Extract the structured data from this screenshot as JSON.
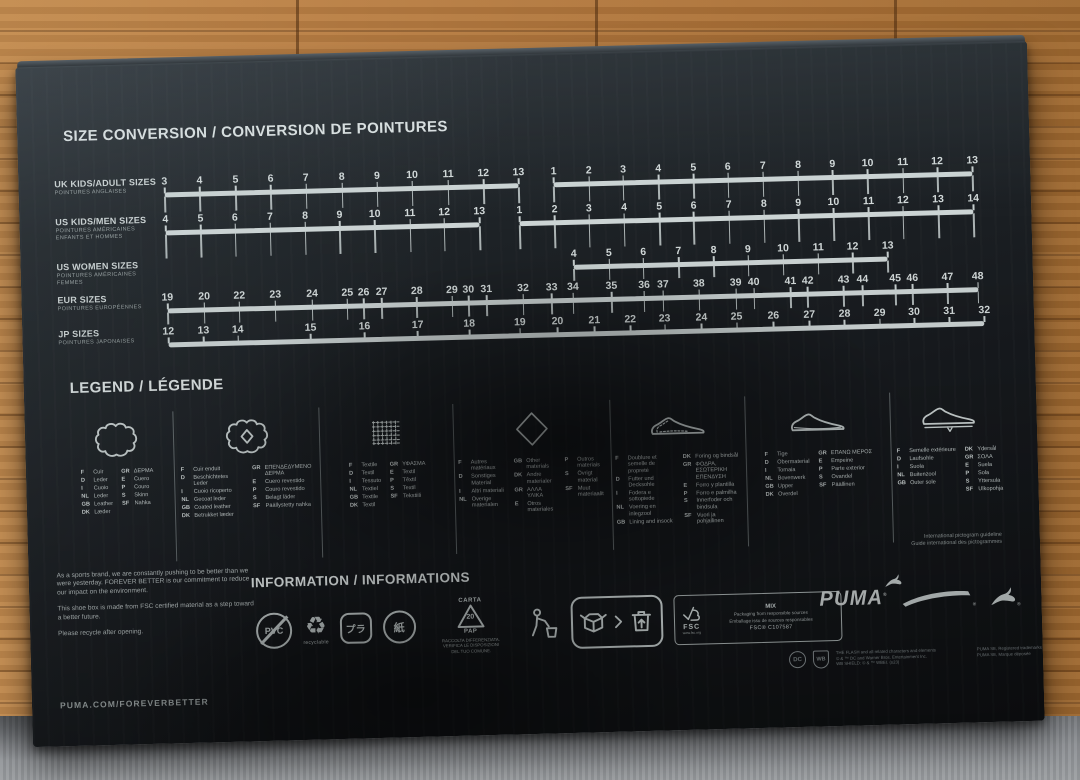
{
  "colors": {
    "print": "#ccd4d4",
    "box": "#1b2024",
    "wood": "#b57b41",
    "carpet": "#8e9195"
  },
  "size_chart": {
    "title": "SIZE CONVERSION / CONVERSION DE POINTURES",
    "rows": [
      {
        "label": "UK KIDS/ADULT SIZES",
        "sublabel": [
          "POINTURES ANGLAISES"
        ],
        "segments": [
          {
            "values": [
              "3",
              "4",
              "5",
              "6",
              "7",
              "8",
              "9",
              "10",
              "11",
              "12",
              "13"
            ],
            "positions": [
              0,
              4.3,
              8.7,
              13,
              17.3,
              21.7,
              26,
              30.3,
              34.7,
              39,
              43.3
            ]
          },
          {
            "values": [
              "1",
              "2",
              "3",
              "4",
              "5",
              "6",
              "7",
              "8",
              "9",
              "10",
              "11",
              "12",
              "13"
            ],
            "positions": [
              47.6,
              51.9,
              56.1,
              60.4,
              64.7,
              68.9,
              73.2,
              77.5,
              81.7,
              86,
              90.3,
              94.5,
              98.8
            ]
          }
        ]
      },
      {
        "label": "US KIDS/MEN SIZES",
        "sublabel": [
          "POINTURES AMÉRICAINES",
          "ENFANTS ET HOMMES"
        ],
        "segments": [
          {
            "values": [
              "4",
              "5",
              "6",
              "7",
              "8",
              "9",
              "10",
              "11",
              "12",
              "13"
            ],
            "positions": [
              0,
              4.3,
              8.5,
              12.8,
              17.1,
              21.3,
              25.6,
              29.9,
              34.1,
              38.4
            ]
          },
          {
            "values": [
              "1",
              "2",
              "3",
              "4",
              "5",
              "6",
              "7",
              "8",
              "9",
              "10",
              "11",
              "12",
              "13",
              "14"
            ],
            "positions": [
              43.3,
              47.6,
              51.8,
              56.1,
              60.4,
              64.6,
              68.9,
              73.2,
              77.4,
              81.7,
              86,
              90.2,
              94.5,
              98.8
            ]
          }
        ]
      },
      {
        "label": "US WOMEN SIZES",
        "sublabel": [
          "POINTURES AMÉRICAINES",
          "FEMMES"
        ],
        "segments": [
          {
            "values": [
              "4",
              "5",
              "6",
              "7",
              "8",
              "9",
              "10",
              "11",
              "12",
              "13"
            ],
            "positions": [
              49.8,
              54.1,
              58.3,
              62.6,
              66.9,
              71.1,
              75.4,
              79.7,
              83.9,
              88.2
            ]
          }
        ]
      },
      {
        "label": "EUR SIZES",
        "sublabel": [
          "POINTURES EUROPÉENNES"
        ],
        "segments": [
          {
            "values": [
              "19",
              "20",
              "22",
              "23",
              "24",
              "25",
              "26",
              "27",
              "28",
              "29",
              "30",
              "31",
              "32",
              "33",
              "34",
              "35",
              "36",
              "37",
              "38",
              "39",
              "40",
              "41",
              "42",
              "43",
              "44",
              "45",
              "46",
              "47",
              "48"
            ],
            "positions": [
              0,
              4.5,
              8.8,
              13.2,
              17.7,
              22,
              24,
              26.2,
              30.5,
              34.8,
              36.8,
              39,
              43.5,
              47,
              49.6,
              54.3,
              58.3,
              60.6,
              65,
              69.5,
              71.7,
              76.2,
              78.3,
              82.7,
              85,
              89,
              91.1,
              95.4,
              99.1
            ]
          }
        ]
      },
      {
        "label": "JP SIZES",
        "sublabel": [
          "POINTURES JAPONAISES"
        ],
        "segments": [
          {
            "values": [
              "12",
              "13",
              "14",
              "15",
              "16",
              "17",
              "18",
              "19",
              "20",
              "21",
              "22",
              "23",
              "24",
              "25",
              "26",
              "27",
              "28",
              "29",
              "30",
              "31",
              "32"
            ],
            "positions": [
              0,
              4.3,
              8.5,
              17.4,
              24,
              30.5,
              36.8,
              43,
              47.6,
              52.1,
              56.5,
              60.7,
              65.2,
              69.5,
              74,
              78.4,
              82.7,
              87,
              91.2,
              95.5,
              99.8
            ]
          }
        ]
      }
    ]
  },
  "legend": {
    "title": "LEGEND / LÉGENDE",
    "footnote": [
      "International pictogram guideline",
      "Guide international des pictogrammes"
    ],
    "columns": [
      {
        "icon": "leather-hide-icon",
        "groups": [
          [
            {
              "c": "F",
              "t": "Cuir"
            },
            {
              "c": "D",
              "t": "Leder"
            },
            {
              "c": "I",
              "t": "Cuoio"
            },
            {
              "c": "NL",
              "t": "Leder"
            },
            {
              "c": "GB",
              "t": "Leather"
            },
            {
              "c": "DK",
              "t": "Læder"
            }
          ],
          [
            {
              "c": "GR",
              "t": "ΔΕΡΜΑ"
            },
            {
              "c": "E",
              "t": "Cuero"
            },
            {
              "c": "P",
              "t": "Couro"
            },
            {
              "c": "S",
              "t": "Skinn"
            },
            {
              "c": "SF",
              "t": "Nahka"
            }
          ]
        ]
      },
      {
        "icon": "coated-leather-icon",
        "groups": [
          [
            {
              "c": "F",
              "t": "Cuir enduit"
            },
            {
              "c": "D",
              "t": "Beschichtetes Leder"
            },
            {
              "c": "I",
              "t": "Cuoio ricoperto"
            },
            {
              "c": "NL",
              "t": "Gecoat leder"
            },
            {
              "c": "GB",
              "t": "Coated leather"
            },
            {
              "c": "DK",
              "t": "Betrukket læder"
            }
          ],
          [
            {
              "c": "GR",
              "t": "ΕΠΕΝΔΕΔΥΜΕΝΟ ΔΕΡΜΑ"
            },
            {
              "c": "E",
              "t": "Cuero revestido"
            },
            {
              "c": "P",
              "t": "Couro revestido"
            },
            {
              "c": "S",
              "t": "Belagt läder"
            },
            {
              "c": "SF",
              "t": "Päällystetty nahka"
            }
          ]
        ]
      },
      {
        "icon": "textile-icon",
        "groups": [
          [
            {
              "c": "F",
              "t": "Textile"
            },
            {
              "c": "D",
              "t": "Textil"
            },
            {
              "c": "I",
              "t": "Tessuto"
            },
            {
              "c": "NL",
              "t": "Textiel"
            },
            {
              "c": "GB",
              "t": "Textile"
            },
            {
              "c": "DK",
              "t": "Textil"
            }
          ],
          [
            {
              "c": "GR",
              "t": "ΥΦΑΣΜΑ"
            },
            {
              "c": "E",
              "t": "Textil"
            },
            {
              "c": "P",
              "t": "Têxtil"
            },
            {
              "c": "S",
              "t": "Textil"
            },
            {
              "c": "SF",
              "t": "Tekstiili"
            }
          ]
        ]
      },
      {
        "icon": "other-materials-icon",
        "groups": [
          [
            {
              "c": "F",
              "t": "Autres matériaux"
            },
            {
              "c": "D",
              "t": "Sonstiges Material"
            },
            {
              "c": "I",
              "t": "Altri materiali"
            },
            {
              "c": "NL",
              "t": "Overige materialen"
            }
          ],
          [
            {
              "c": "GB",
              "t": "Other materials"
            },
            {
              "c": "DK",
              "t": "Andre materialer"
            },
            {
              "c": "GR",
              "t": "ΑΛΛΑ ΥΛΙΚΑ"
            },
            {
              "c": "E",
              "t": "Otros materiales"
            }
          ],
          [
            {
              "c": "P",
              "t": "Outros materiais"
            },
            {
              "c": "S",
              "t": "Övrigt material"
            },
            {
              "c": "SF",
              "t": "Muut materiaalit"
            }
          ]
        ]
      },
      {
        "icon": "lining-insock-icon",
        "groups": [
          [
            {
              "c": "F",
              "t": "Doublure et semelle de propreté"
            },
            {
              "c": "D",
              "t": "Futter und Decksohle"
            },
            {
              "c": "I",
              "t": "Fodera e sottopiede"
            },
            {
              "c": "NL",
              "t": "Voering en inlegzool"
            },
            {
              "c": "GB",
              "t": "Lining and insock"
            }
          ],
          [
            {
              "c": "DK",
              "t": "Foring og bindsål"
            },
            {
              "c": "GR",
              "t": "ΦΟΔΡΑ, ΕΣΩΤΕΡΙΚΗ ΕΠΕΝΔΥΣΗ"
            },
            {
              "c": "E",
              "t": "Forro y plantilla"
            },
            {
              "c": "P",
              "t": "Forro e palmilha"
            },
            {
              "c": "S",
              "t": "Innerfoder och bindsula"
            },
            {
              "c": "SF",
              "t": "Vuori ja pohjallinen"
            }
          ]
        ]
      },
      {
        "icon": "upper-icon",
        "groups": [
          [
            {
              "c": "F",
              "t": "Tige"
            },
            {
              "c": "D",
              "t": "Obermaterial"
            },
            {
              "c": "I",
              "t": "Tomaia"
            },
            {
              "c": "NL",
              "t": "Bovenwerk"
            },
            {
              "c": "GB",
              "t": "Upper"
            },
            {
              "c": "DK",
              "t": "Overdel"
            }
          ],
          [
            {
              "c": "GR",
              "t": "ΕΠΑΝΩ ΜΕΡΟΣ"
            },
            {
              "c": "E",
              "t": "Empeine"
            },
            {
              "c": "P",
              "t": "Parte exterior"
            },
            {
              "c": "S",
              "t": "Ovandel"
            },
            {
              "c": "SF",
              "t": "Päällinen"
            }
          ]
        ]
      },
      {
        "icon": "outsole-icon",
        "groups": [
          [
            {
              "c": "F",
              "t": "Semelle extérieure"
            },
            {
              "c": "D",
              "t": "Laufsohle"
            },
            {
              "c": "I",
              "t": "Suola"
            },
            {
              "c": "NL",
              "t": "Buitenzool"
            },
            {
              "c": "GB",
              "t": "Outer sole"
            }
          ],
          [
            {
              "c": "DK",
              "t": "Ydersål"
            },
            {
              "c": "GR",
              "t": "ΣΟΛΑ"
            },
            {
              "c": "E",
              "t": "Suela"
            },
            {
              "c": "P",
              "t": "Sola"
            },
            {
              "c": "S",
              "t": "Yttersula"
            },
            {
              "c": "SF",
              "t": "Ulkopohja"
            }
          ]
        ]
      }
    ]
  },
  "information": {
    "title": "INFORMATION / INFORMATIONS",
    "paragraphs": [
      "As a sports brand, we are constantly pushing to be better than we were yesterday. FOREVER BETTER is our commitment to reduce our impact on the environment.",
      "This shoe box is made from FSC certified material as a step toward a better future.",
      "Please recycle after opening."
    ],
    "site": "PUMA.COM/FOREVERBETTER",
    "icons": {
      "pvc": "PVC",
      "recyclable": "recyclable",
      "pla": "プラ",
      "kami": "紙",
      "carta": "CARTA",
      "code20": "20",
      "pap": "PAP",
      "raccolta": [
        "RACCOLTA DIFFERENZIATA.",
        "VERIFICA LE DISPOSIZIONI",
        "DEL TUO COMUNE."
      ]
    },
    "fsc": {
      "label": "FSC",
      "url": "www.fsc.org",
      "mix": "MIX",
      "line1": "Packaging from responsible sources",
      "line2": "Emballage issu de sources responsables",
      "code": "FSC® C107587"
    },
    "brand": {
      "wordmark": "PUMA"
    },
    "credits": {
      "dc": "DC",
      "wb": "WB",
      "flash": [
        "THE FLASH and all related characters and elements",
        "© & ™ DC and Warner Bros. Entertainment Inc.",
        "WB SHIELD: © & ™ WBEI. (s23)"
      ],
      "puma": [
        "PUMA SE, Registered trademarks",
        "PUMA SE, Marque déposée"
      ]
    }
  },
  "misc": {
    "reg": "®",
    "recycle_glyph": "♻"
  }
}
